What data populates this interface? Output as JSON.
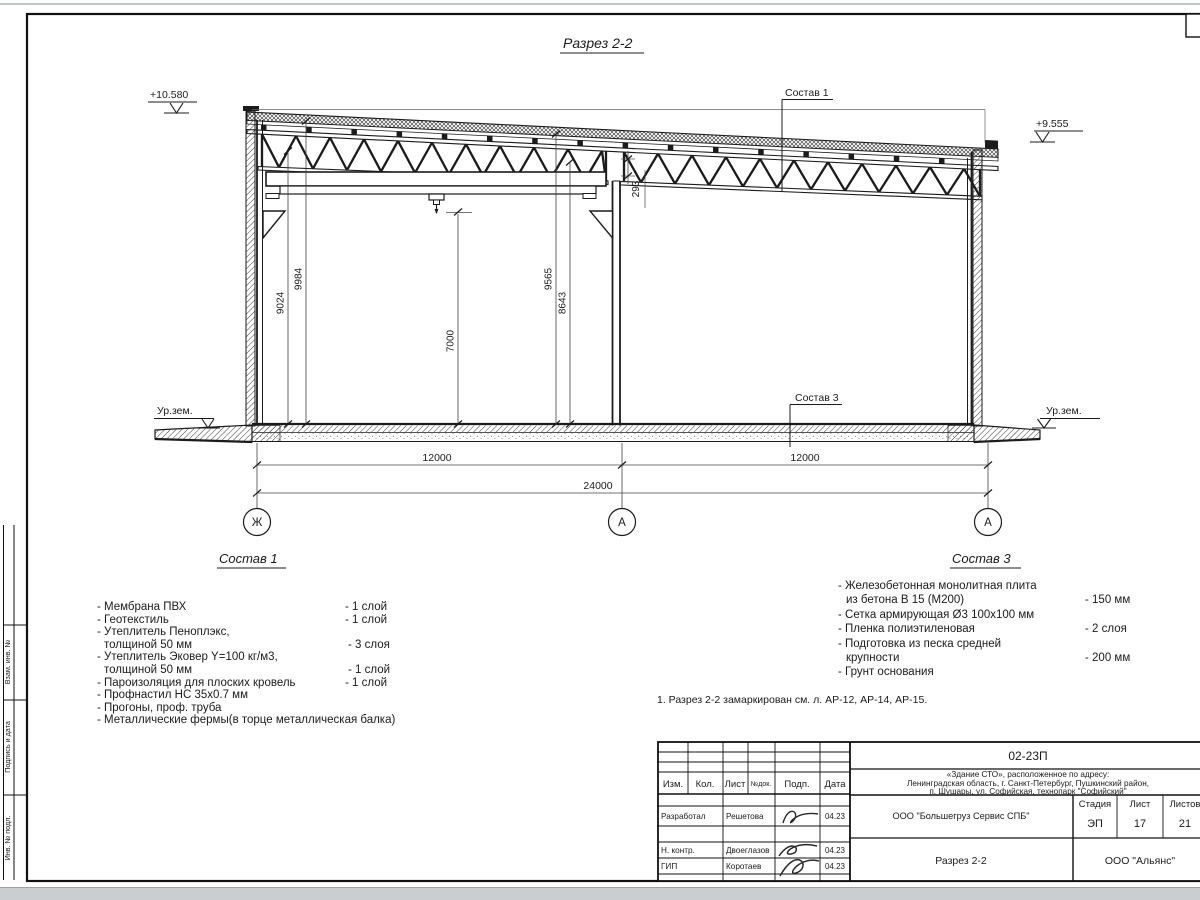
{
  "drawing": {
    "title": "Разрез 2-2",
    "elev_left": "+10.580",
    "elev_right": "+9.555",
    "ground_left": "Ур.зем.",
    "ground_right": "Ур.зем.",
    "leader1": "Состав 1",
    "leader3": "Состав 3",
    "vdims": [
      "9024",
      "9984",
      "7000",
      "9565",
      "8643"
    ],
    "gap_dim": "293",
    "hdims": [
      "12000",
      "12000",
      "24000"
    ],
    "axes": [
      "Ж",
      "А",
      "А"
    ]
  },
  "sostav1": {
    "heading": "Состав 1",
    "items": [
      {
        "text": "- Мембрана ПВХ",
        "qty": "- 1 слой"
      },
      {
        "text": "- Геотекстиль",
        "qty": "- 1 слой"
      },
      {
        "text": "- Утеплитель Пеноплэкс,",
        "qty": ""
      },
      {
        "text": "толщиной 50 мм",
        "qty": "- 3 слоя"
      },
      {
        "text": "- Утеплитель Эковер Y=100 кг/м3,",
        "qty": ""
      },
      {
        "text": "толщиной 50 мм",
        "qty": "- 1 слой"
      },
      {
        "text": "- Пароизоляция для плоских кровель",
        "qty": "- 1 слой"
      },
      {
        "text": "- Профнастил НС 35х0.7 мм",
        "qty": ""
      },
      {
        "text": "- Прогоны, проф. труба",
        "qty": ""
      },
      {
        "text": "- Металлические фермы(в торце металлическая балка)",
        "qty": ""
      }
    ]
  },
  "sostav3": {
    "heading": "Состав 3",
    "items": [
      {
        "text": "- Железобетонная  монолитная плита",
        "qty": ""
      },
      {
        "text": "из бетона В 15 (М200)",
        "qty": "- 150 мм"
      },
      {
        "text": "- Сетка армирующая Ø3 100х100 мм",
        "qty": ""
      },
      {
        "text": "- Пленка полиэтиленовая",
        "qty": "-  2 слоя"
      },
      {
        "text": "- Подготовка из песка средней",
        "qty": ""
      },
      {
        "text": "крупности",
        "qty": "- 200 мм"
      },
      {
        "text": "- Грунт основания",
        "qty": ""
      }
    ]
  },
  "note": "1. Разрез 2-2 замаркирован см. л. АР-12, АР-14, АР-15.",
  "frame": {
    "side_labels": [
      "Взам. инв. №",
      "Подпись и дата",
      "Инв. № подл."
    ]
  },
  "titleblock": {
    "code": "02-23П",
    "address_lines": [
      "«Здание СТО», расположенное по адресу:",
      "Ленинградская область, г. Санкт-Петербург, Пушкинский район,",
      "п. Шушары, ул. Софийская, технопарк \"Софийский\""
    ],
    "header_cols": [
      "Изм.",
      "Кол.",
      "Лист",
      "№док.",
      "Подп.",
      "Дата"
    ],
    "rows": [
      {
        "role": "Разработал",
        "name": "Решетова",
        "date": "04.23"
      },
      {
        "role": "Н. контр.",
        "name": "Двоеглазов",
        "date": "04.23"
      },
      {
        "role": "ГИП",
        "name": "Коротаев",
        "date": "04.23"
      }
    ],
    "org": "ООО \"Большегруз Сервис СПБ\"",
    "doc_title": "Разрез 2-2",
    "stage_label": "Стадия",
    "sheet_label": "Лист",
    "sheets_label": "Листов",
    "stage": "ЭП",
    "sheet": "17",
    "sheets": "21",
    "company": "ООО \"Альянс\""
  }
}
